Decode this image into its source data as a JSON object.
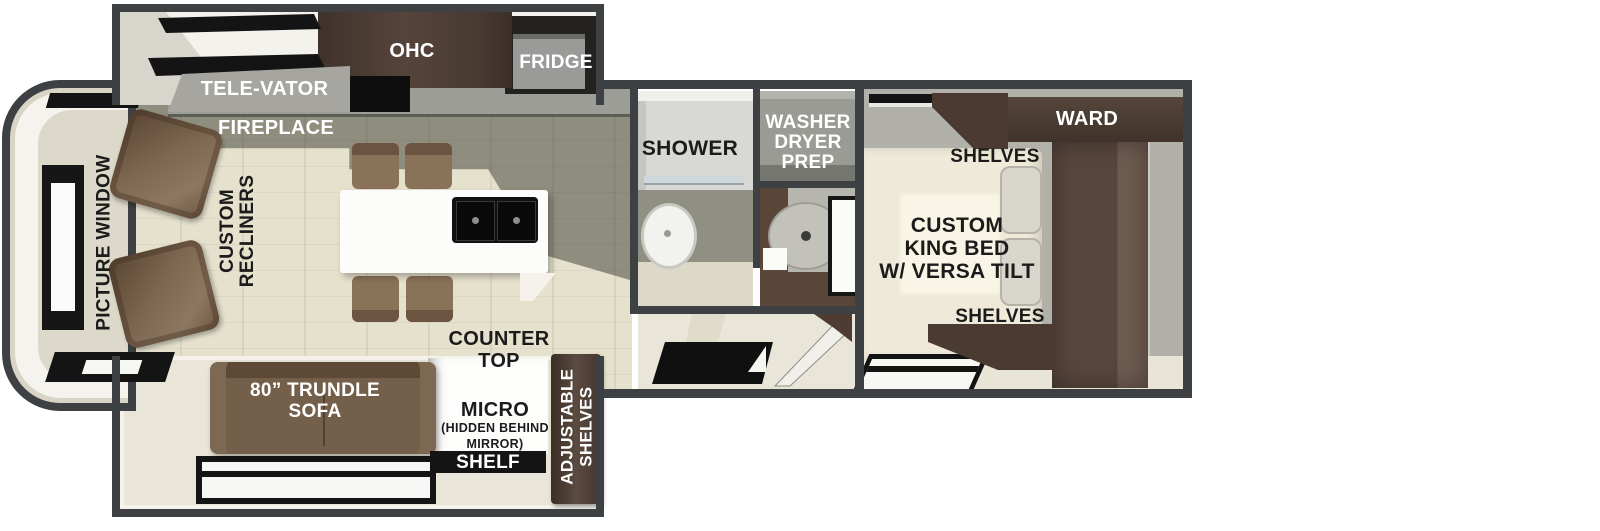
{
  "title": "Travel trailer floor plan",
  "colors": {
    "wall": "#3e4143",
    "floor_cream": "#e8e4d6",
    "floor_olive": "#8f8e7e",
    "wood_dark": "#4a3a31",
    "furniture_brown": "#74604a",
    "label_white": "#ffffff",
    "label_black": "#1b1b1b",
    "fireplace_flame": "#f3a81c"
  },
  "labels": {
    "televator": "TELE-VATOR",
    "fireplace": "FIREPLACE",
    "ohc": "OHC",
    "fridge": "FRIDGE",
    "picture_window": "PICTURE WINDOW",
    "recliners": "CUSTOM\nRECLINERS",
    "counter_top": "COUNTER\nTOP",
    "trundle_sofa": "80” TRUNDLE\nSOFA",
    "micro": "MICRO",
    "micro_note": "(HIDDEN BEHIND\nMIRROR)",
    "shelf": "SHELF",
    "adjustable_shelves": "ADJUSTABLE\nSHELVES",
    "shower": "SHOWER",
    "washer_prep": "WASHER\nDRYER\nPREP",
    "ward": "WARD",
    "shelves_top": "SHELVES",
    "king_bed": "CUSTOM\nKING BED\nW/ VERSA TILT",
    "shelves_bottom": "SHELVES"
  }
}
